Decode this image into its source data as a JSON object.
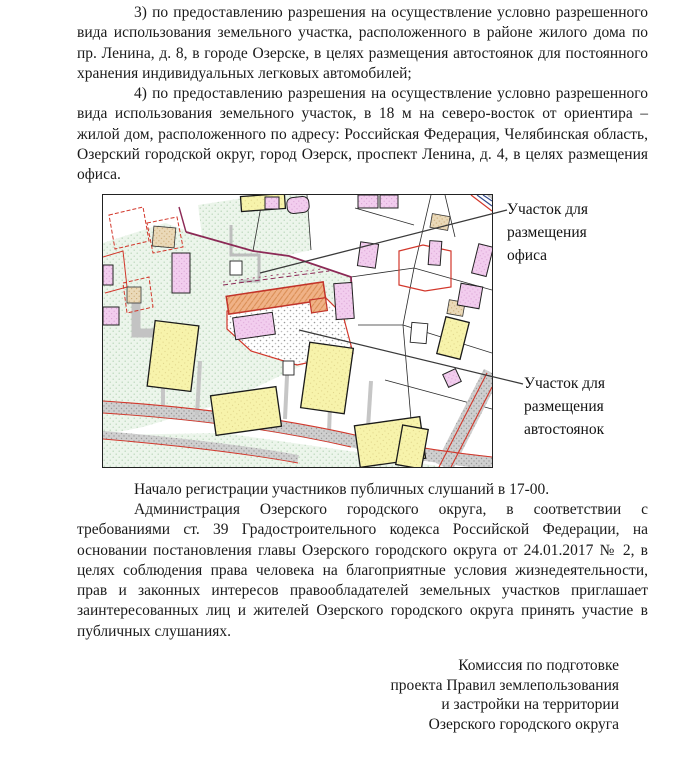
{
  "document": {
    "paragraph_3": "3) по предоставлению разрешения на осуществление условно разрешенного вида использования земельного участка, расположенного в районе жилого дома по пр. Ленина, д. 8, в городе Озерске, в целях размещения автостоянок для постоянного хранения индивидуальных легковых автомобилей;",
    "paragraph_4": "4) по предоставлению разрешения на осуществление условно разрешенного вида использования земельного участок, в 18 м на северо-восток от ориентира – жилой дом, расположенного по адресу: Российская Федерация, Челябинская область, Озерский городской округ, город Озерск, проспект Ленина, д. 4, в целях размещения офиса.",
    "registration_line": "Начало регистрации участников публичных слушаний в 17-00.",
    "administration_paragraph": "Администрация Озерского городского округа, в соответствии с требованиями ст. 39 Градостроительного кодекса Российской Федерации, на основании постановления главы Озерского городского округа от 24.01.2017 № 2, в целях соблюдения права человека на благоприятные условия жизнедеятельности, прав и законных интересов правообладателей земельных участков приглашает заинтересованных лиц и жителей Озерского городского округа принять участие в публичных слушаниях.",
    "signature": [
      "Комиссия по подготовке",
      "проекта Правил землепользования",
      "и застройки на территории",
      "Озерского городского округа"
    ]
  },
  "map": {
    "label_office": "Участок для размещения офиса",
    "label_parking": "Участок для размещения автостоянок",
    "colors": {
      "parcel_green": "#ecf5eb",
      "building_yellow": "#f7f3ab",
      "building_pink": "#f2cdee",
      "building_tan": "#ead9b8",
      "focus_plot_orange": "#f0b287",
      "boundary_red": "#d2372b",
      "boundary_purple": "#8c2a56",
      "road_gray": "#cfcfcf",
      "callout_line": "#3a3a3a"
    }
  }
}
